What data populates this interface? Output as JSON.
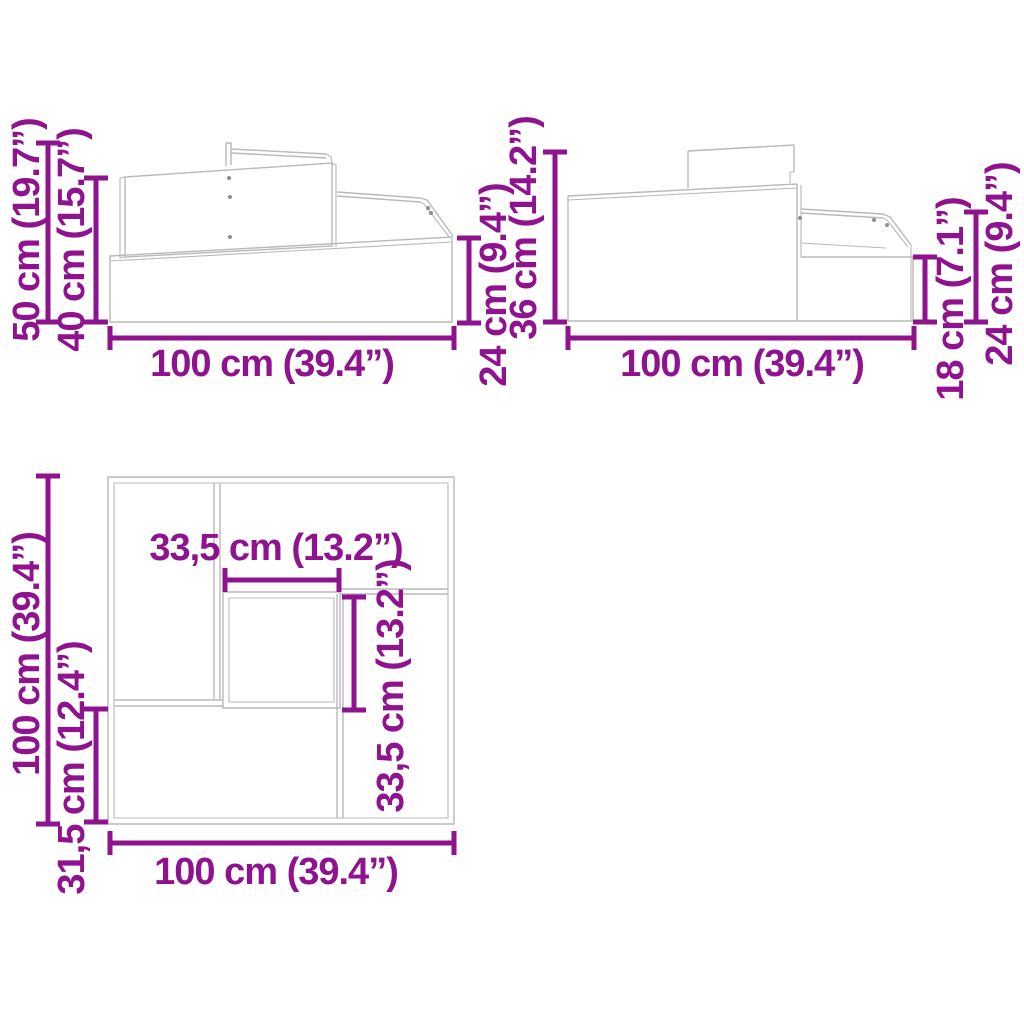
{
  "colors": {
    "dimension": "#8f128f",
    "drawing": "#b9b9b9",
    "drawing-dark": "#8d8d8d",
    "background": "#ffffff"
  },
  "diagram": {
    "description": "3-tier planter dimension drawing, three views"
  },
  "views": {
    "side_left": {
      "name": "left side view",
      "dims": {
        "total_height": "50 cm (19.7”)",
        "mid_height": "40 cm (15.7”)",
        "right_tier_height": "24 cm (9.4”)",
        "width": "100 cm (39.4”)"
      }
    },
    "side_right": {
      "name": "right side view",
      "dims": {
        "left_height": "36 cm (14.2”)",
        "step_height": "18 cm (7.1”)",
        "right_height": "24 cm (9.4”)",
        "width": "100 cm (39.4”)"
      }
    },
    "top": {
      "name": "top view",
      "dims": {
        "depth": "100 cm (39.4”)",
        "lower_section_depth": "31,5 cm (12.4”)",
        "inner_width": "33,5 cm (13.2”)",
        "inner_depth": "33,5 cm (13.2”)",
        "width": "100 cm (39.4”)"
      }
    }
  }
}
